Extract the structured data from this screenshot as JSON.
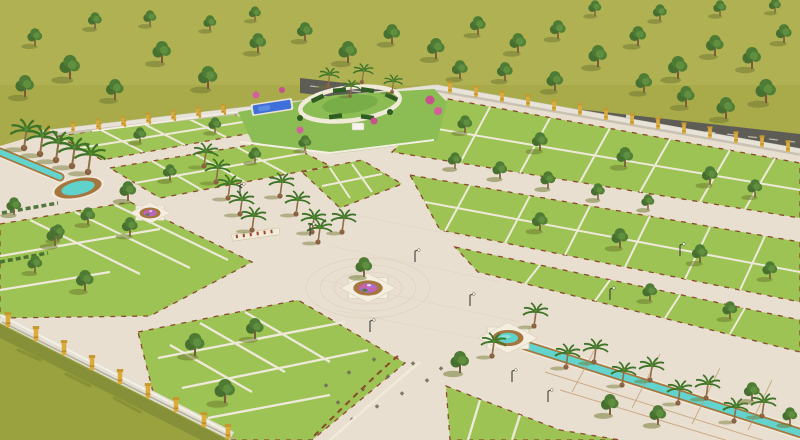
{
  "meta": {
    "title": "Aerial 3D render of a gated residential plotted land development with landscaped park, canals and green plots",
    "type": "architectural-visualization",
    "no_visible_text": true
  },
  "colors": {
    "field": "#a9ab4b",
    "field_shade": "#9aa23f",
    "paver": "#e9dfd0",
    "plot": "#9cc353",
    "plot_divider": "#efe9da",
    "curb_red": "#8a4a2c",
    "park": "#8cbd55",
    "park_ring": "#f2ead9",
    "hedge": "#2f5c22",
    "pool": "#3f6fd8",
    "canal": "#62d4cd",
    "water_rim_earth": "#a5763f",
    "water_rim_light": "#f0e8d8",
    "pond": "#5fd2cb",
    "flower_purple": "#b268cf",
    "flower_pink": "#d45f9f",
    "tree_canopy": "#4e7c35",
    "palm_frond": "#3e7427",
    "trunk": "#8f6e48",
    "wall_face": "#e3dfd3",
    "wall_pillar_gold": "#dcab3e",
    "outer_road": "#5d5d55",
    "road_dash": "#cfcfc6",
    "lamp_pole": "#3c3c36",
    "shadow_olive": "#6b762e"
  },
  "scene": {
    "setting": "flat olive-green countryside dotted with trees",
    "site": "walled plotted township seen from a high oblique angle",
    "features": [
      "central landscaped park with circular walkway, topiary hedges, palms and a blue play pool",
      "cream paver boulevards and plazas",
      "bright green residential plots divided by pale stone strips",
      "two octagonal flower medallions at road junctions",
      "star-shaped pond feeding a long teal water canal toward the lower right",
      "short teal canal ending in a curved pond at the left",
      "palm-lined promenades",
      "perimeter wall with golden pillars",
      "dark service road running behind the rear wall",
      "street lamps and paver accent dots along internal roads"
    ],
    "water_features": {
      "canals": 2,
      "ponds": 2,
      "flower_medallions": 2
    }
  }
}
